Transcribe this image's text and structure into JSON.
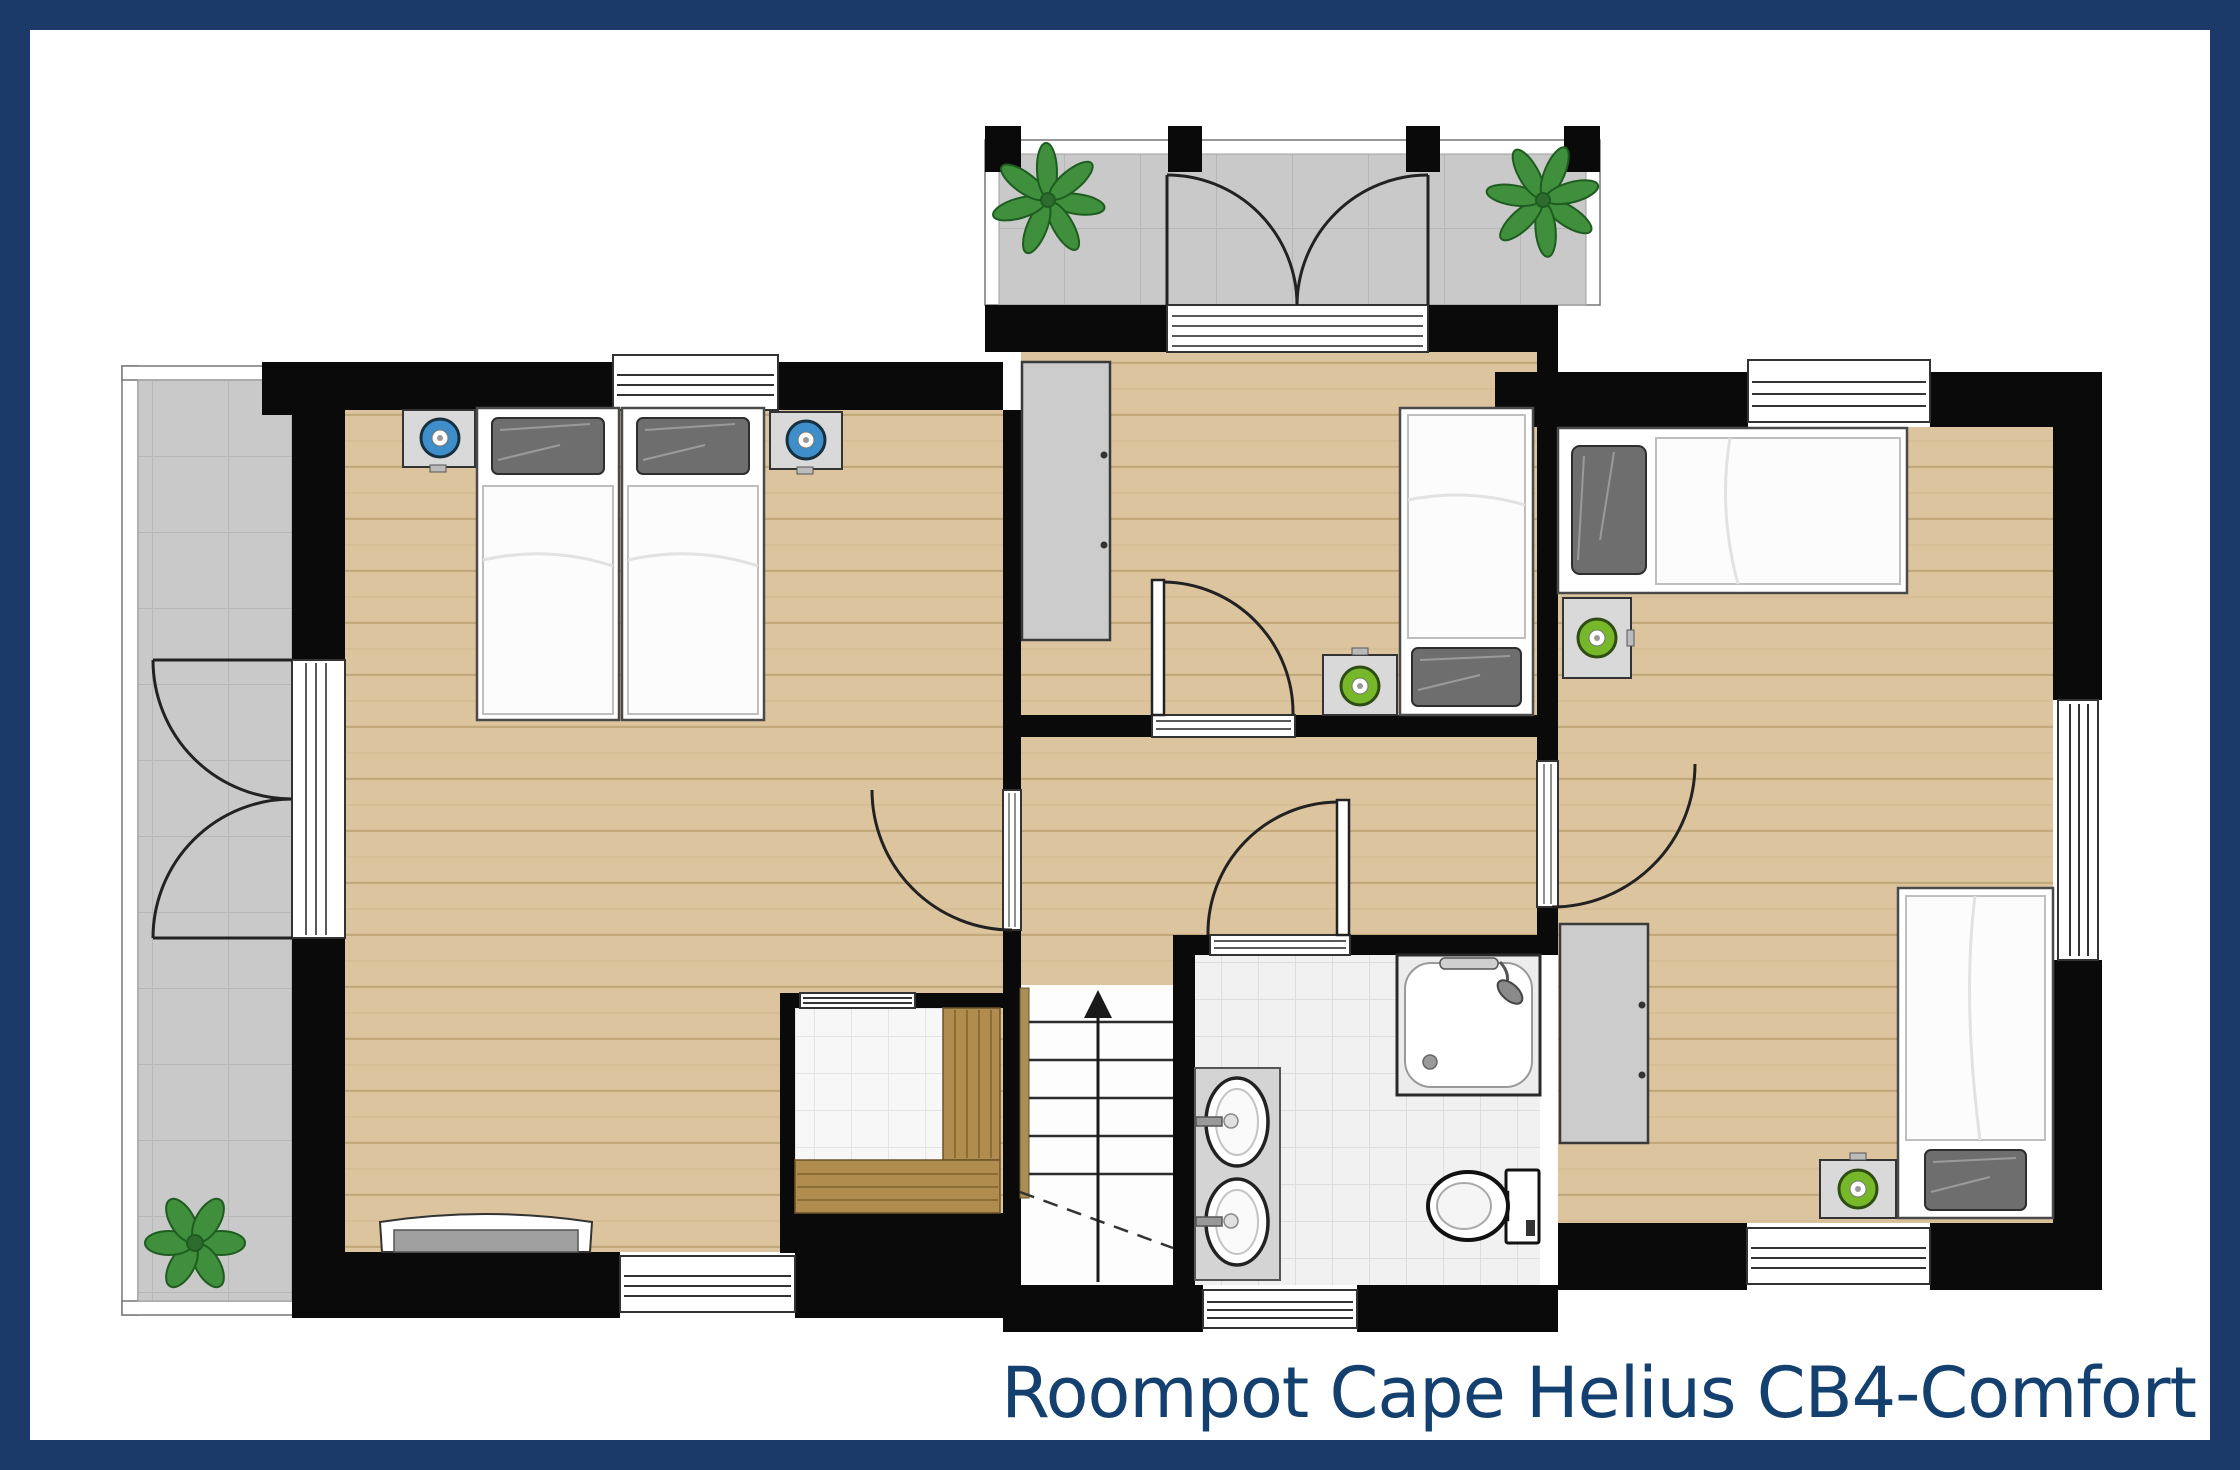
{
  "title": {
    "text": "Roompot Cape Helius CB4-Comfort"
  },
  "colors": {
    "frame_navy": "#1b3a69",
    "title_navy": "#14406f",
    "wall_black": "#0a0a0a",
    "wood_floor": "#dcc59e",
    "terrace_tile_gray": "#c9c9c9",
    "bathroom_tile": "#f1f1f1",
    "sauna_tile": "#f7f7f7",
    "lamp_blue": "#3e8ec9",
    "lamp_green": "#76b82a",
    "plant_green": "#3f8f3d",
    "bench_wood": "#b08d4f"
  },
  "floor_plan": {
    "rooms": [
      {
        "name": "balcony",
        "features": [
          "railing",
          "tiled-floor",
          "pillar-icon x4",
          "potted-plant-icon x2",
          "double-french-door"
        ]
      },
      {
        "name": "terrace",
        "features": [
          "railing",
          "tiled-floor",
          "potted-plant-icon",
          "double-french-door"
        ]
      },
      {
        "name": "master-bedroom",
        "features": [
          "double-bed (2 singles)",
          "pillow-icon x2",
          "nightstand x2",
          "blue-lamp-icon x2",
          "sideboard",
          "window x2",
          "door-to-hallway"
        ]
      },
      {
        "name": "bedroom-2",
        "features": [
          "single-bed",
          "pillow-icon",
          "nightstand",
          "green-lamp-icon",
          "wardrobe",
          "door-swing",
          "balcony-door"
        ]
      },
      {
        "name": "bedroom-3",
        "features": [
          "single-bed x2",
          "pillow-icon x2",
          "nightstand x2",
          "green-lamp-icon x2",
          "wardrobe",
          "window x3",
          "door-swing"
        ]
      },
      {
        "name": "bathroom",
        "features": [
          "shower-tray",
          "shower-head-icon",
          "grab-bar",
          "vanity",
          "sink-icon x2",
          "faucet-icon x2",
          "toilet-icon",
          "window",
          "door-swing"
        ]
      },
      {
        "name": "sauna",
        "features": [
          "wooden-bench x2",
          "tiled-floor",
          "glazed-panel"
        ]
      },
      {
        "name": "staircase",
        "features": [
          "treads x5",
          "up-arrow-icon",
          "dashed-cut-line",
          "handrail"
        ]
      },
      {
        "name": "hallway",
        "features": [
          "wood-floor",
          "door-openings x4"
        ]
      }
    ],
    "stairs_direction": "up",
    "window_count": 8,
    "plant_count": 3
  }
}
